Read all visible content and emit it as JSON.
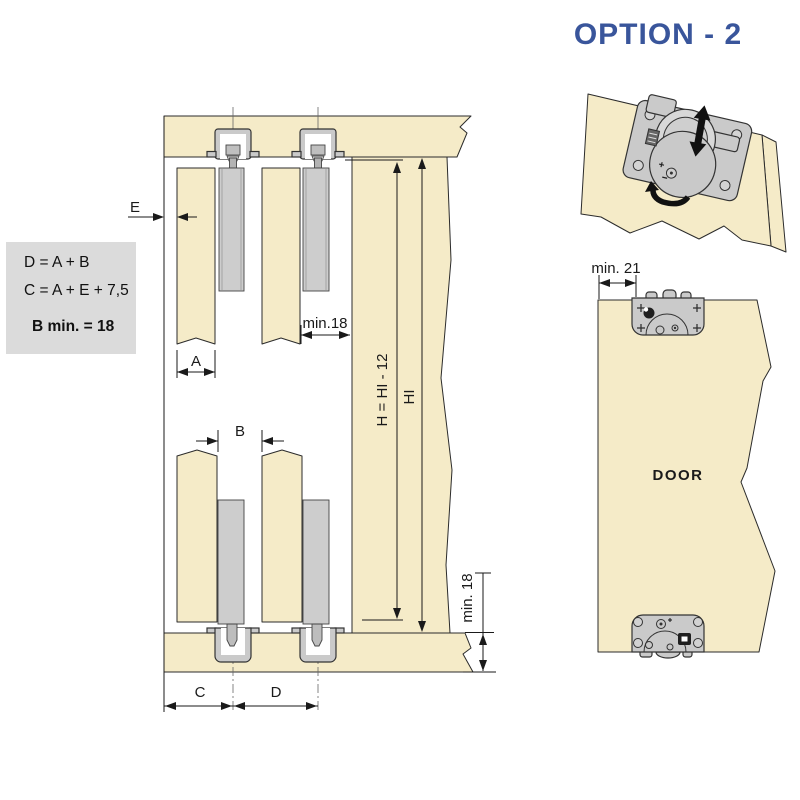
{
  "title": {
    "text": "OPTION - 2"
  },
  "formula_box": {
    "formula_d": "D = A + B",
    "formula_c": "C = A + E + 7,5",
    "formula_b_min": "B min. = 18"
  },
  "diagram": {
    "dim_e": "E",
    "dim_a": "A",
    "dim_b": "B",
    "dim_c": "C",
    "dim_d": "D",
    "dim_min18_top": "min.18",
    "dim_h": "H = HI - 12",
    "dim_hi": "HI",
    "dim_min18_bottom": "min. 18"
  },
  "illustration": {
    "dim_min21": "min. 21",
    "door_label": "DOOR"
  },
  "colors": {
    "accent_blue": "#39559B",
    "panel_cream": "#F5EBC8",
    "hardware_gray": "#CACACA",
    "formula_box_bg": "#DBDBDB"
  }
}
